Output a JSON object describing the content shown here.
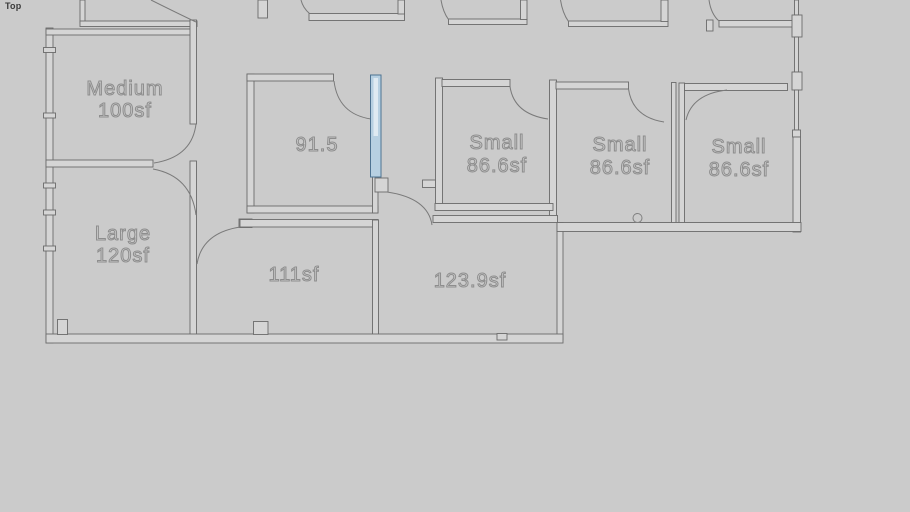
{
  "viewport": {
    "view_label": "Top",
    "background_color": "#cbcbcb",
    "wall_line_color": "#6b6b6b",
    "label_color": "#8d8d8d",
    "selection_fill_color": "#b7d0e2",
    "selection_stroke_color": "#4e7392"
  },
  "floor_plan": {
    "rooms": [
      {
        "id": "medium",
        "name": "Medium",
        "area": "100sf"
      },
      {
        "id": "large",
        "name": "Large",
        "area": "120sf"
      },
      {
        "id": "room-91",
        "name": "91.5",
        "area": ""
      },
      {
        "id": "room-111",
        "name": "111sf",
        "area": ""
      },
      {
        "id": "room-123",
        "name": "123.9sf",
        "area": ""
      },
      {
        "id": "small-1",
        "name": "Small",
        "area": "86.6sf"
      },
      {
        "id": "small-2",
        "name": "Small",
        "area": "86.6sf"
      },
      {
        "id": "small-3",
        "name": "Small",
        "area": "86.6sf"
      }
    ]
  }
}
